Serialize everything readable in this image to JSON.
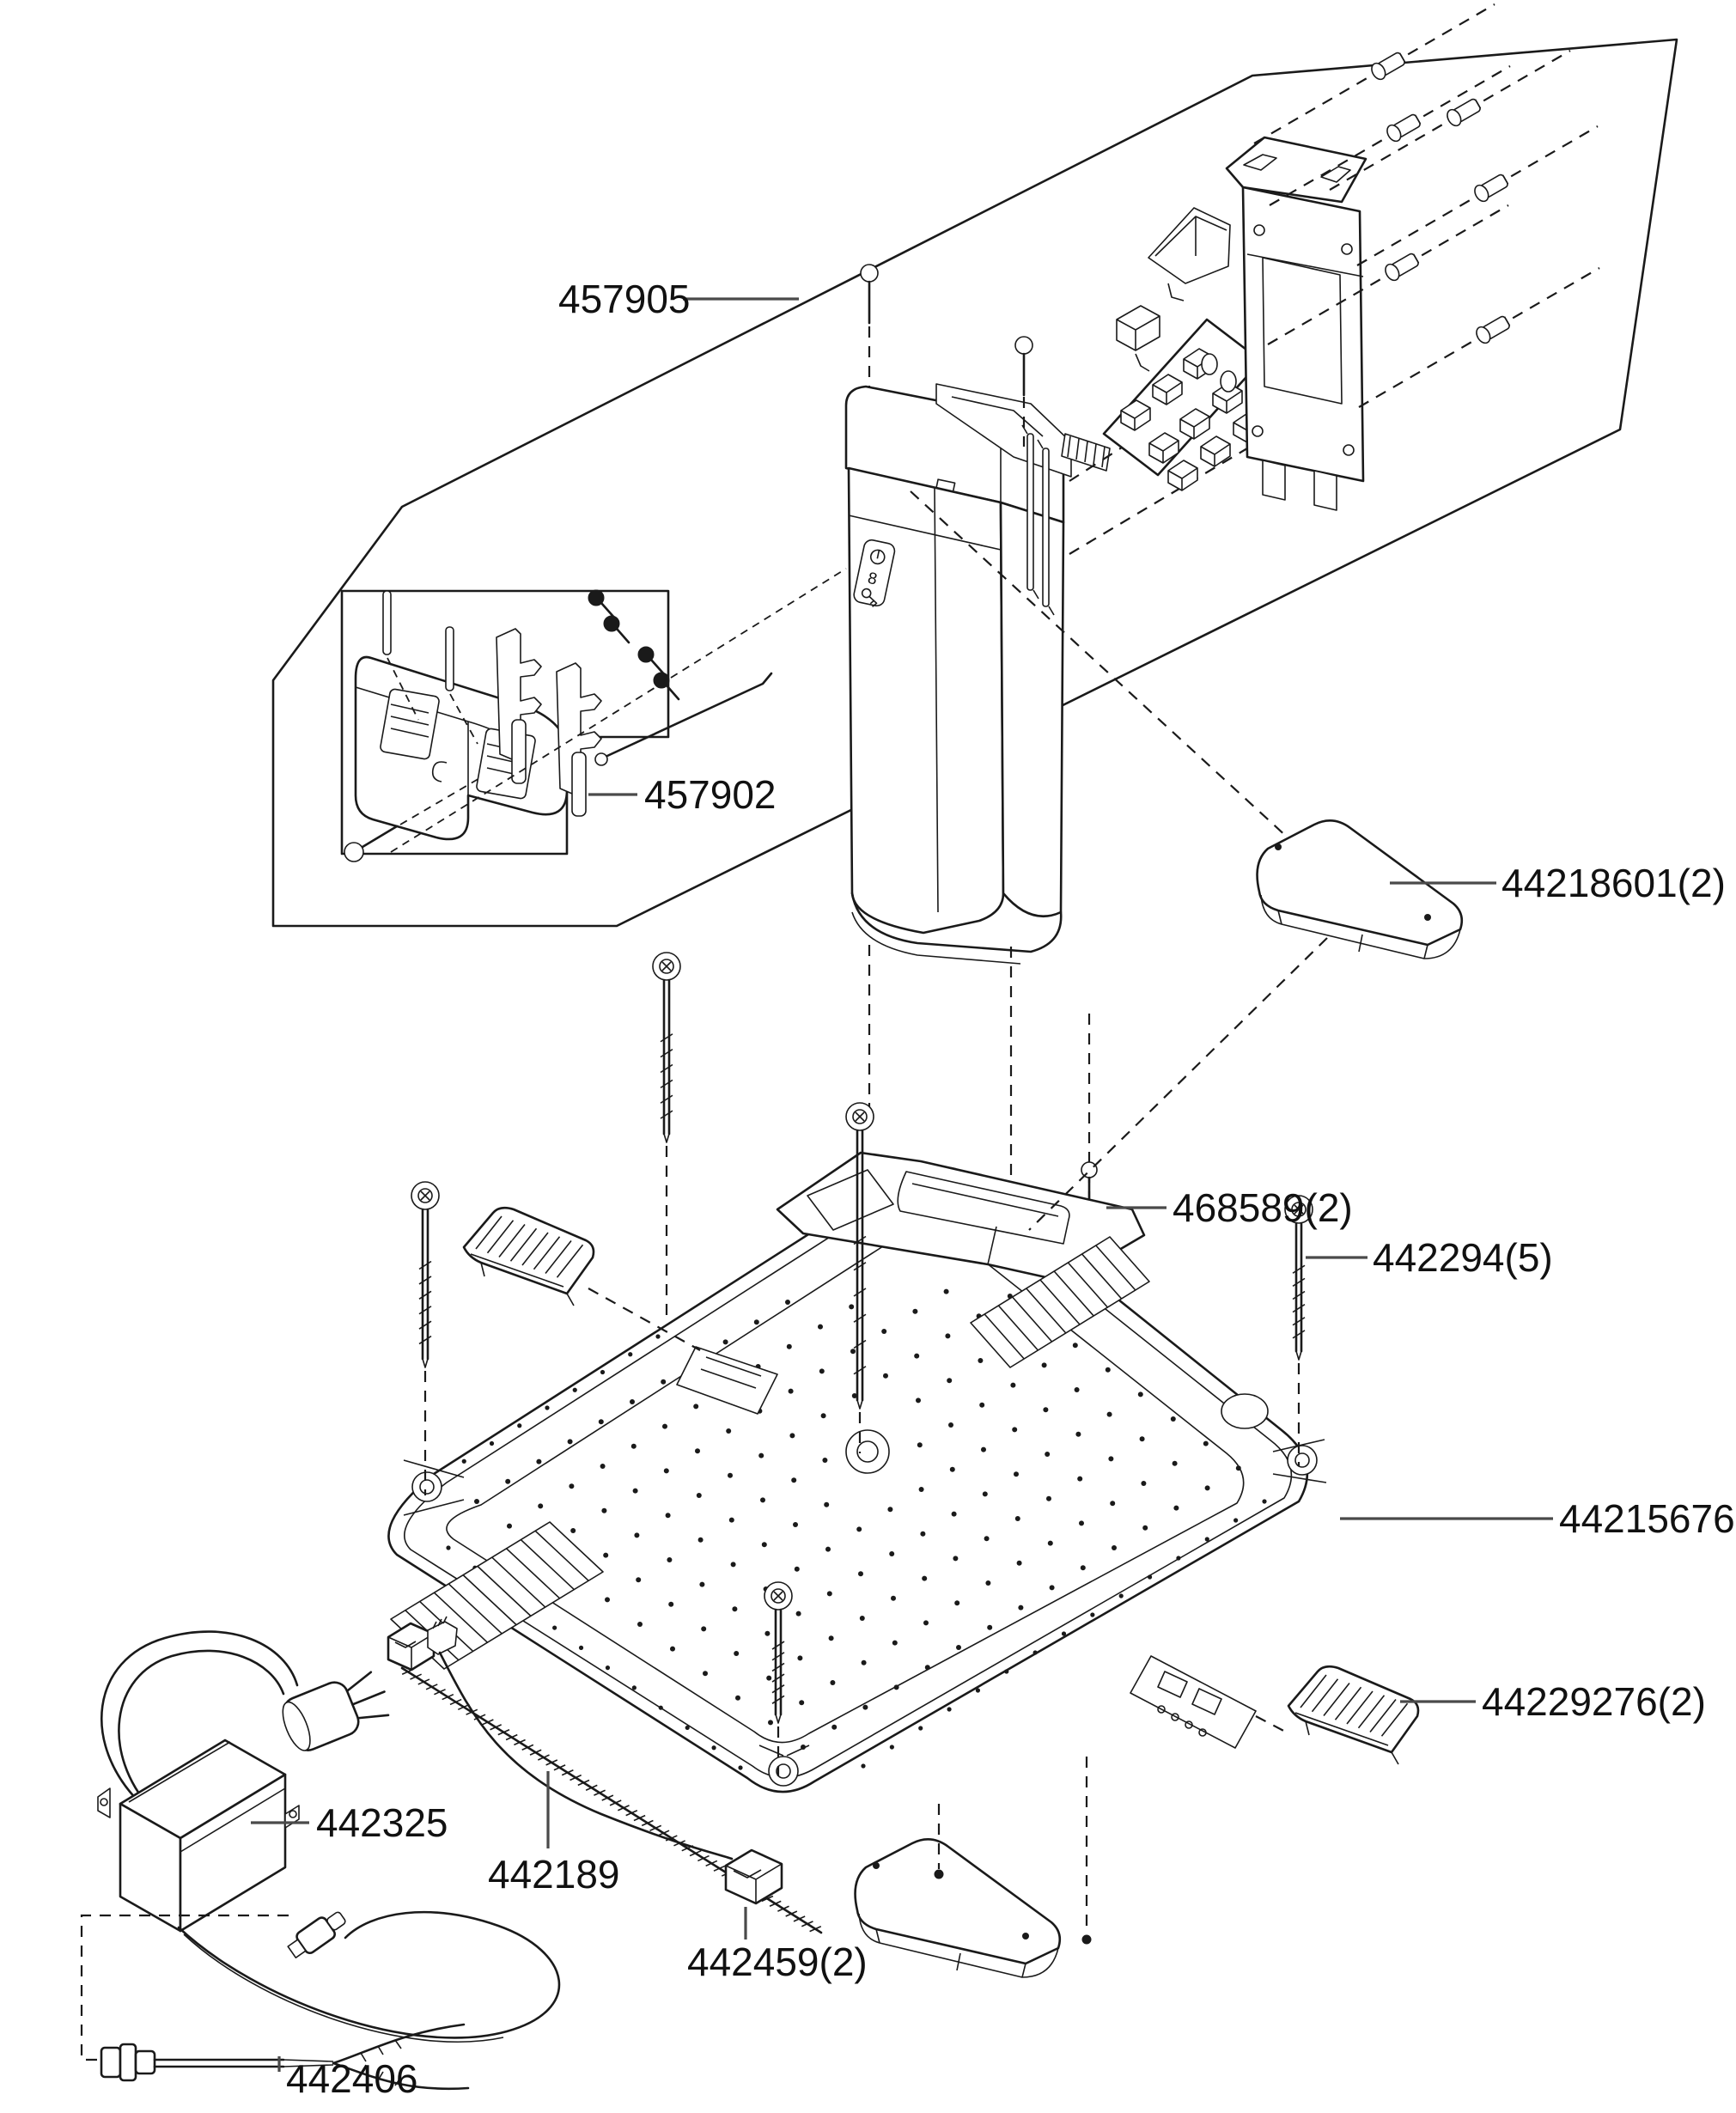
{
  "diagram": {
    "type": "exploded-parts-diagram",
    "subject": "robotic-mower-charging-station",
    "background_color": "#ffffff",
    "line_color": "#1a1a1a",
    "label_color": "#111111"
  },
  "labels": [
    {
      "id": "457905",
      "text": "457905"
    },
    {
      "id": "457902",
      "text": "457902"
    },
    {
      "id": "44218601",
      "text": "44218601(2)"
    },
    {
      "id": "468589",
      "text": "468589(2)"
    },
    {
      "id": "442294",
      "text": "442294(5)"
    },
    {
      "id": "44215676",
      "text": "44215676"
    },
    {
      "id": "44229276",
      "text": "44229276(2)"
    },
    {
      "id": "442325",
      "text": "442325"
    },
    {
      "id": "442189",
      "text": "442189"
    },
    {
      "id": "442459",
      "text": "442459(2)"
    },
    {
      "id": "442406",
      "text": "442406"
    }
  ],
  "parts": [
    {
      "part_number": "457905",
      "quantity_shown": 1
    },
    {
      "part_number": "457902",
      "quantity_shown": 1
    },
    {
      "part_number": "44218601",
      "quantity_shown": 2
    },
    {
      "part_number": "468589",
      "quantity_shown": 2
    },
    {
      "part_number": "442294",
      "quantity_shown": 5
    },
    {
      "part_number": "44215676",
      "quantity_shown": 1
    },
    {
      "part_number": "44229276",
      "quantity_shown": 2
    },
    {
      "part_number": "442325",
      "quantity_shown": 1
    },
    {
      "part_number": "442189",
      "quantity_shown": 1
    },
    {
      "part_number": "442459",
      "quantity_shown": 2
    },
    {
      "part_number": "442406",
      "quantity_shown": 1
    }
  ],
  "tower_panel": {
    "digit": "8",
    "icons": [
      "power-icon",
      "digit-8-icon",
      "key-icon"
    ]
  }
}
